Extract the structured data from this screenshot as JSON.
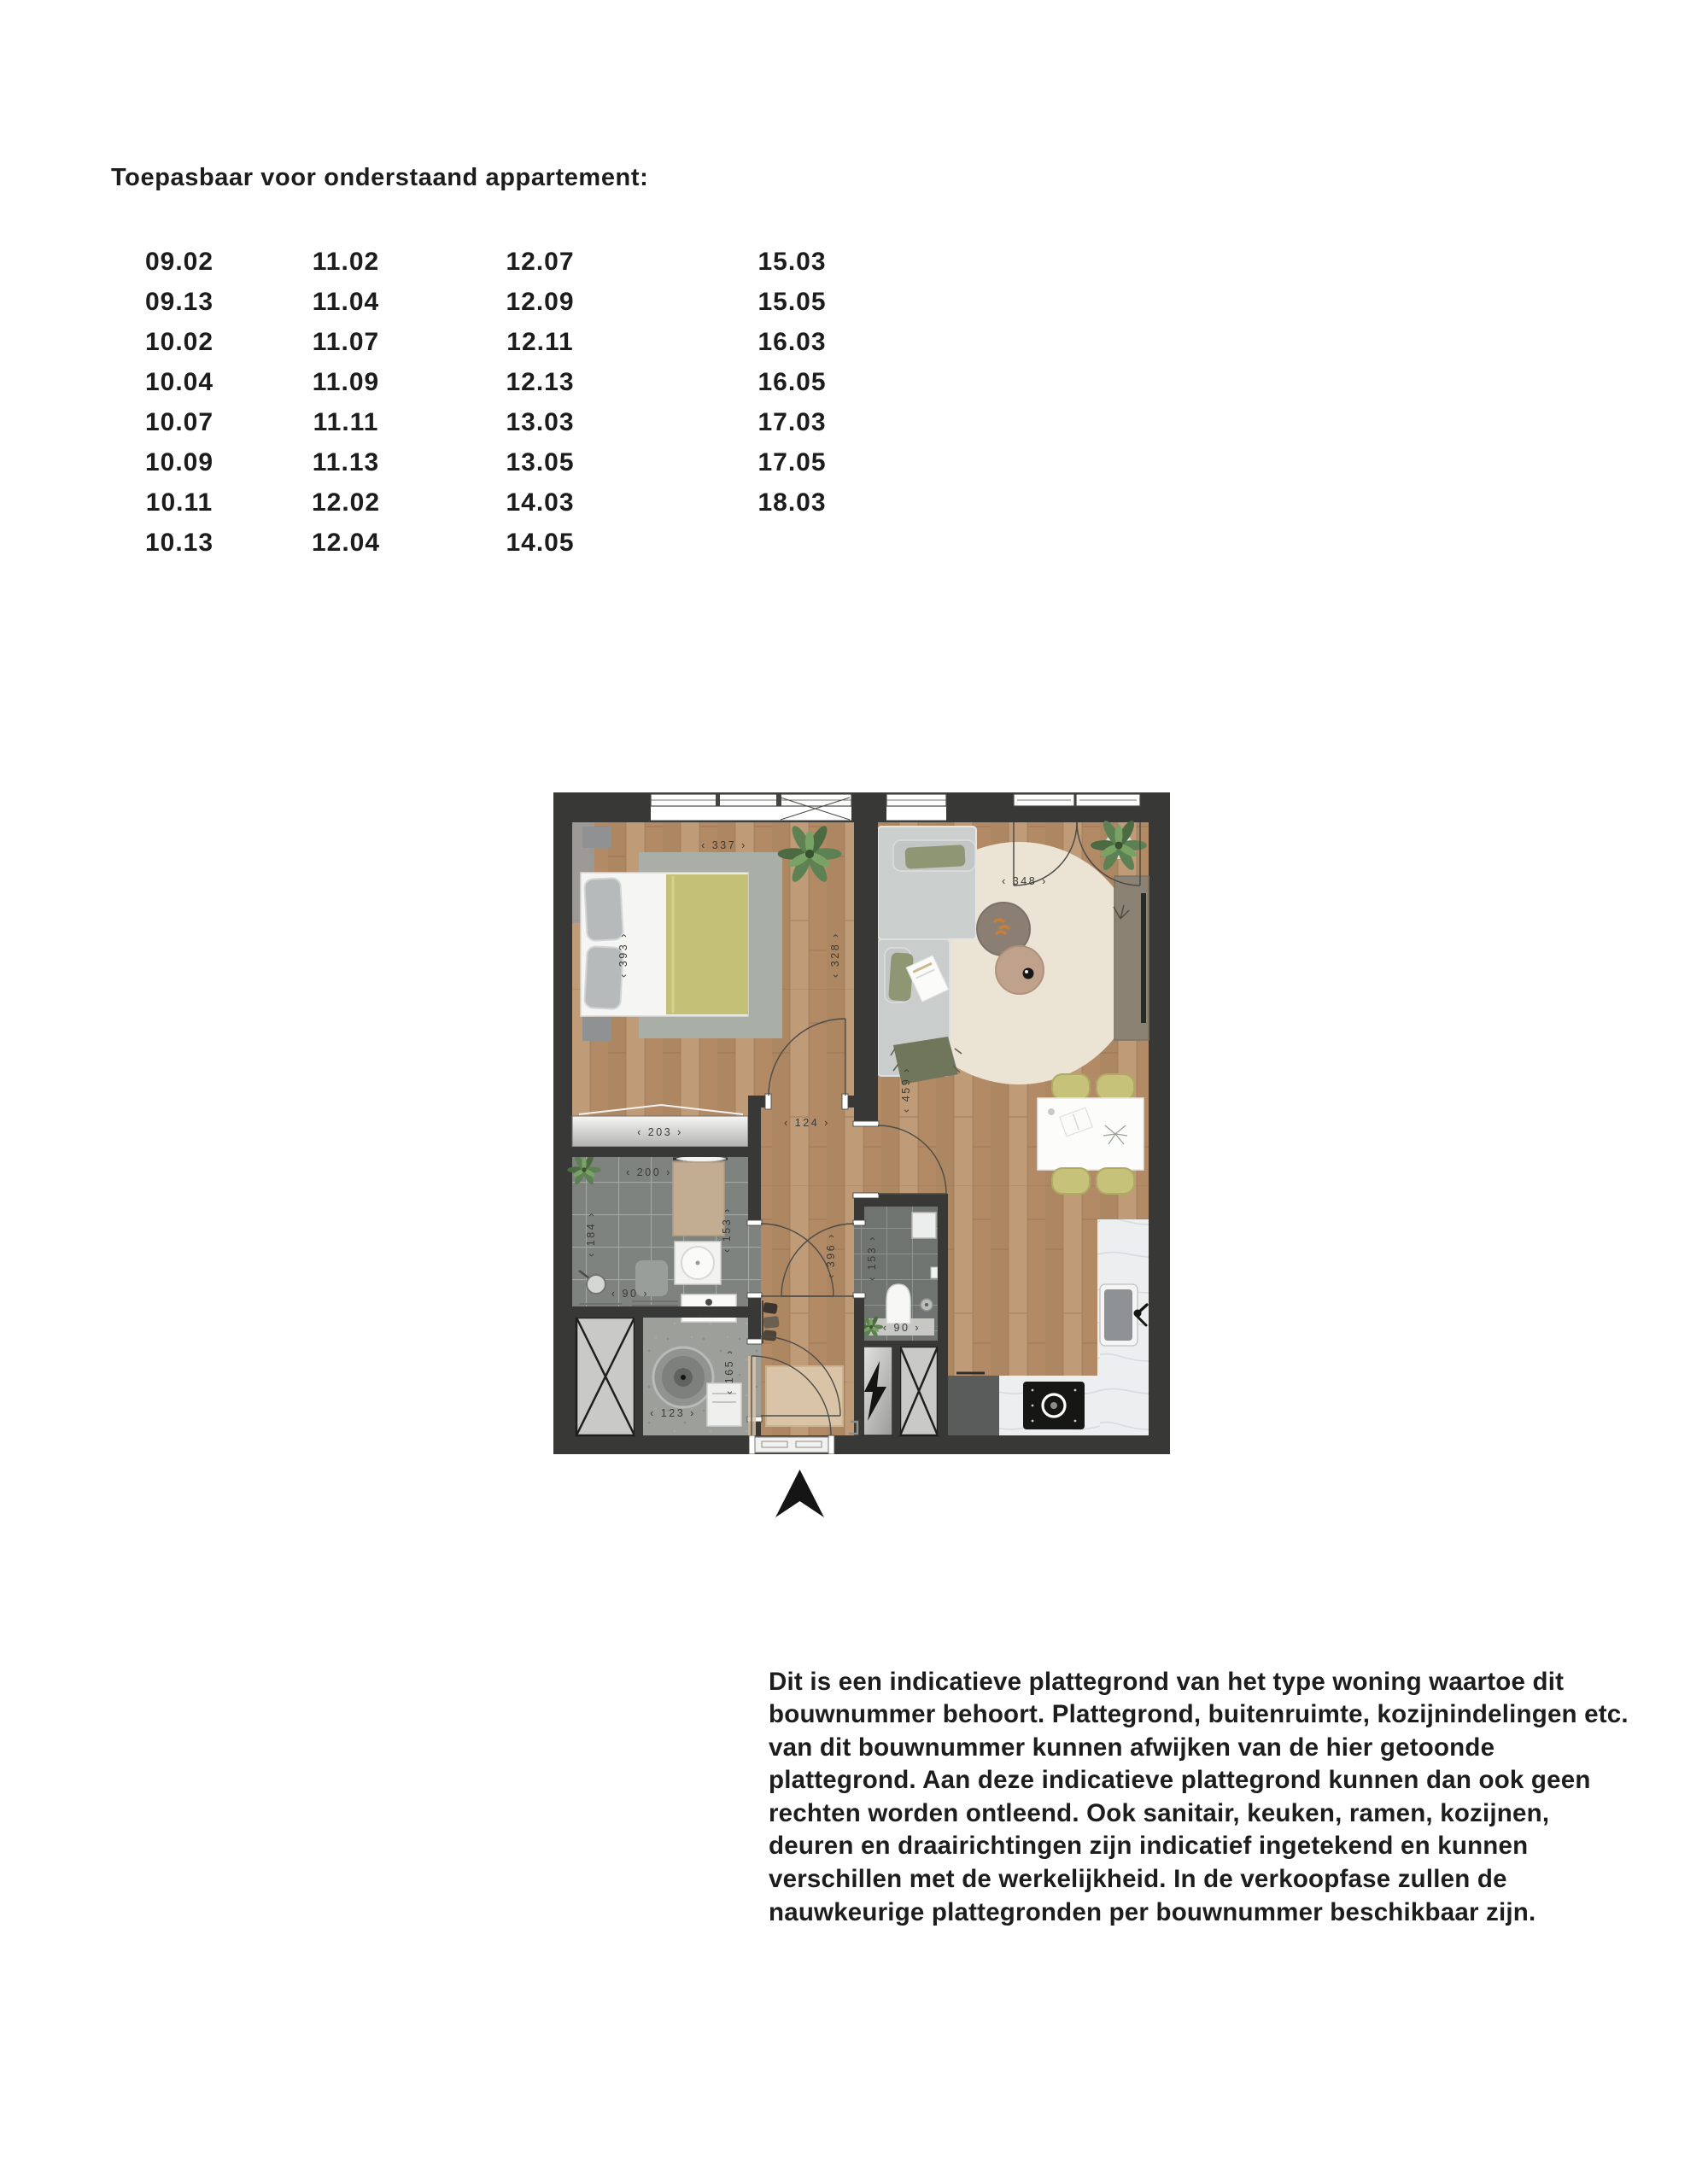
{
  "title": "Toepasbaar voor onderstaand appartement:",
  "apartments": {
    "columns": [
      [
        "09.02",
        "09.13",
        "10.02",
        "10.04",
        "10.07",
        "10.09",
        "10.11",
        "10.13"
      ],
      [
        "11.02",
        "11.04",
        "11.07",
        "11.09",
        "11.11",
        "11.13",
        "12.02",
        "12.04"
      ],
      [
        "12.07",
        "12.09",
        "12.11",
        "12.13",
        "13.03",
        "13.05",
        "14.03",
        "14.05"
      ],
      [
        "15.03",
        "15.05",
        "16.03",
        "16.05",
        "17.03",
        "17.05",
        "18.03"
      ]
    ]
  },
  "floorplan": {
    "dims": {
      "bedroom_width": "‹ 337 ›",
      "bedroom_depth": "‹ 393 ›",
      "bedroom_depth_right": "‹ 328 ›",
      "wardrobe_width": "‹ 203 ›",
      "bathroom_width": "‹ 200 ›",
      "bathroom_depth": "‹ 184 ›",
      "bathroom_depth_right": "‹ 153 ›",
      "shower_width": "‹ 90 ›",
      "laundry_counter_width": "‹ 100 ›",
      "laundry_width": "‹ 123 ›",
      "laundry_depth": "‹ 165 ›",
      "hall_width": "‹ 124 ›",
      "hall_depth": "‹ 396 ›",
      "wc_depth": "‹ 153 ›",
      "wc_width": "‹ 90 ›",
      "living_width": "‹ 348 ›",
      "living_depth": "‹ 459 ›"
    },
    "icons": {
      "north_arrow": "north-arrow",
      "electric_panel": "lightning-bolt",
      "shaft": "crossed-box",
      "shower": "shower-head"
    },
    "colors": {
      "wall": "#383836",
      "wood_floor": "#b7916d",
      "bathroom_tile": "#7e8380",
      "wc_tile": "#6f7471",
      "concrete_floor": "#9da09a",
      "bedroom_rug": "#a9afa6",
      "living_rug": "#ebe3d4",
      "duvet_green": "#c4c078",
      "chair_green": "#c7c27a",
      "sofa_gray": "#cbcfce",
      "kitchen_marble": "#edeef0",
      "counter_dark": "#5a5c5b",
      "entry_mat": "#d9c4a8",
      "plant_green": "#5d8152"
    }
  },
  "disclaimer": "Dit is een indicatieve plattegrond van het type woning waartoe dit bouwnummer behoort. Plattegrond, buitenruimte, kozijnindelingen etc. van dit bouwnummer kunnen afwijken van de hier getoonde plattegrond. Aan deze indicatieve plattegrond kunnen dan ook geen rechten worden ontleend. Ook sanitair, keuken, ramen, kozijnen, deuren en draairichtingen zijn indicatief ingetekend en kunnen verschillen met de werkelijkheid. In de verkoopfase zullen de nauwkeurige plattegronden per bouwnummer beschikbaar zijn."
}
